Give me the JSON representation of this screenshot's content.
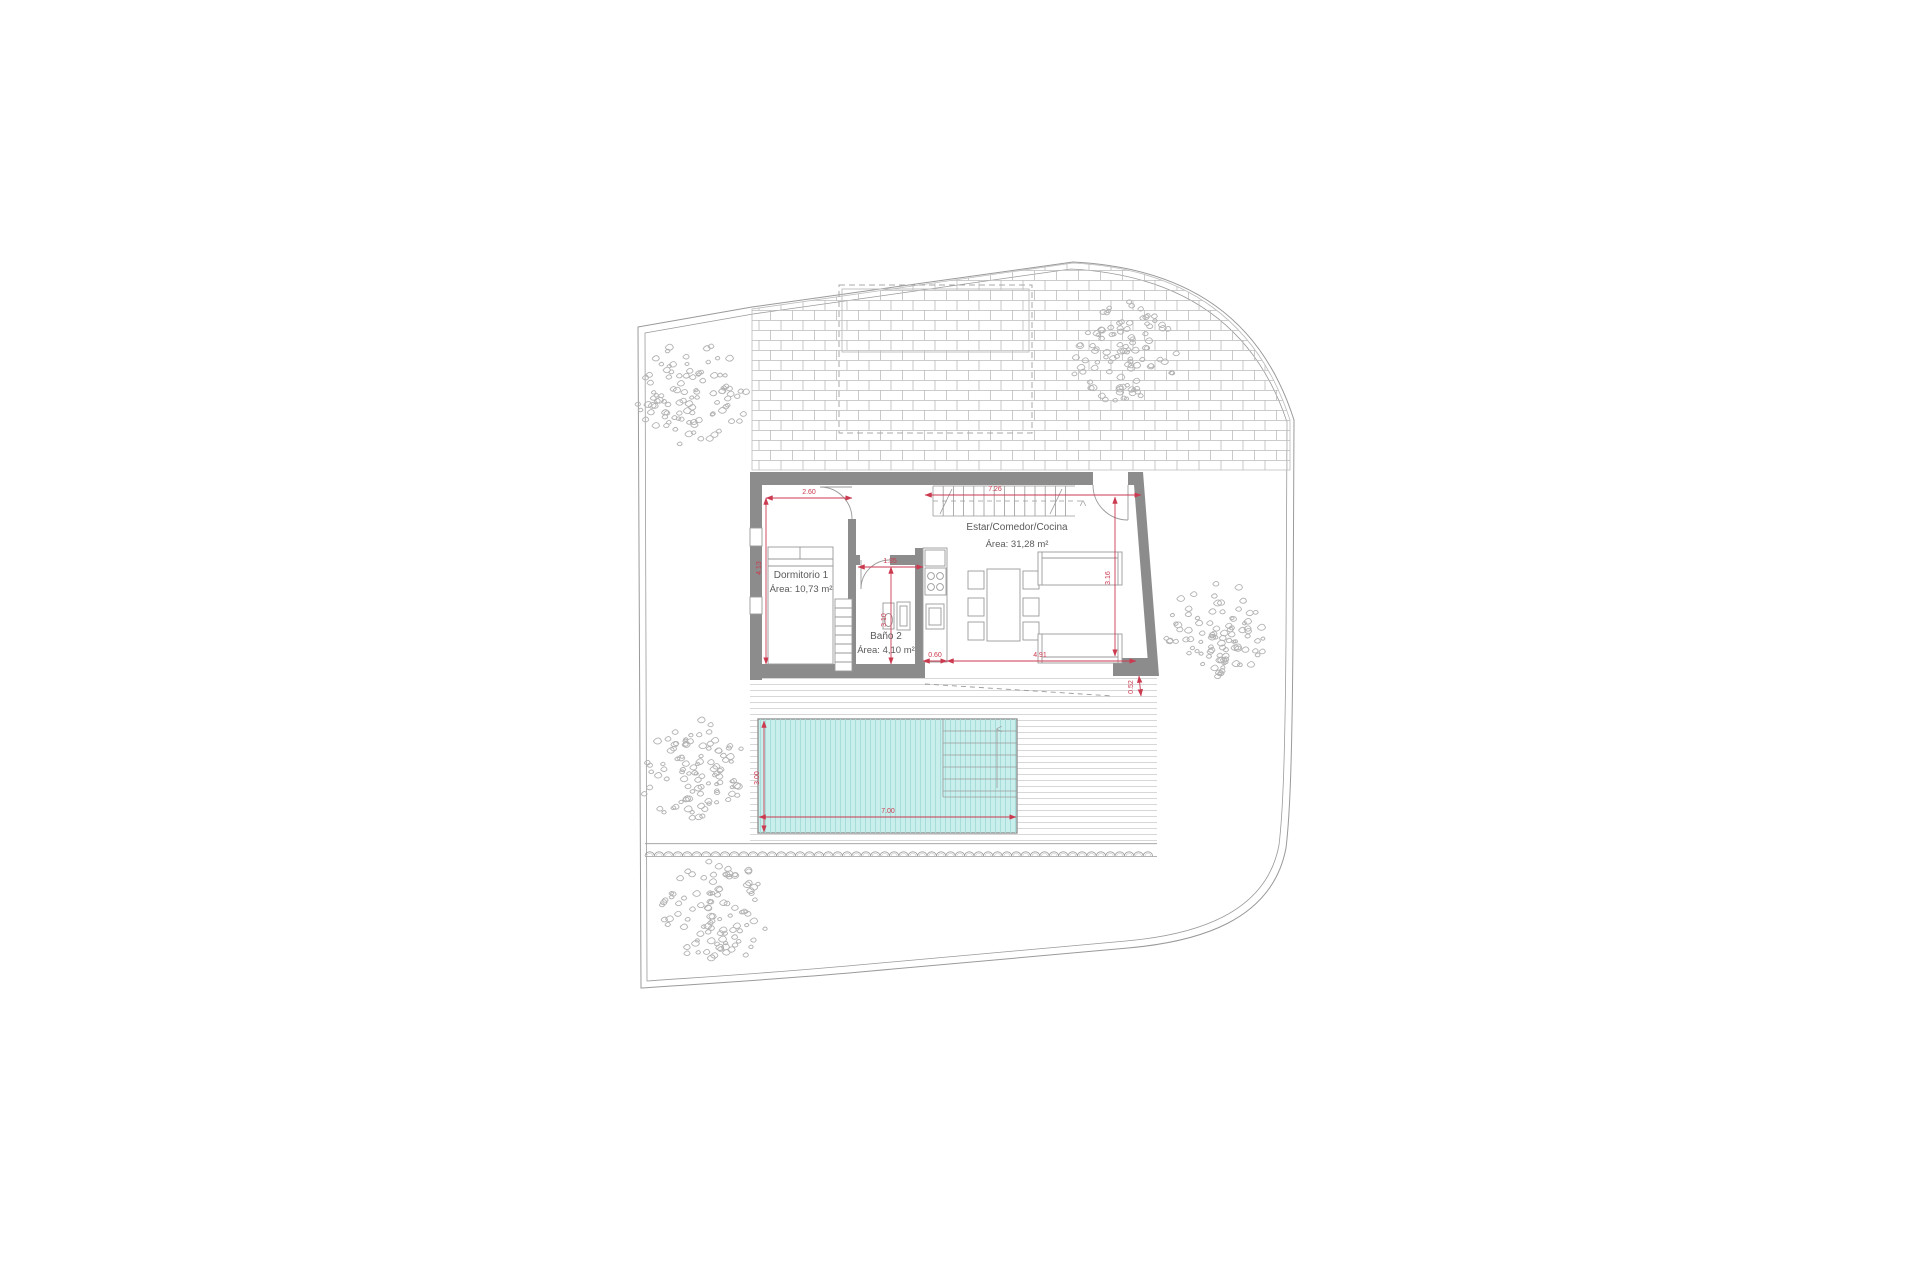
{
  "drawing": {
    "title": "floor-plan",
    "rooms": {
      "dormitorio": {
        "name": "Dormitorio 1",
        "area": "Área: 10,73 m²"
      },
      "bano": {
        "name": "Baño 2",
        "area": "Área: 4,10 m²"
      },
      "estar": {
        "name": "Estar/Comedor/Cocina",
        "area": "Área: 31,28 m²"
      }
    },
    "dimensions": {
      "bedroom_width": "2.60",
      "bedroom_depth": "4.13",
      "bath_width": "1.35",
      "bath_depth": "3.10",
      "living_width": "7.26",
      "living_depth": "3.16",
      "counter_gap": "0.60",
      "living_span": "4.91",
      "deck_gap": "0.52",
      "pool_width": "3.00",
      "pool_length": "7.00"
    },
    "colors": {
      "wall": "#8c8c8c",
      "dimension": "#cc3a50",
      "pool_fill": "#c9efec",
      "pool_stripe": "#a2dcd9",
      "line": "#9a9a9a",
      "light_line": "#c9c9c9",
      "tree": "#b3b3b3",
      "text": "#5a5a5a"
    }
  }
}
